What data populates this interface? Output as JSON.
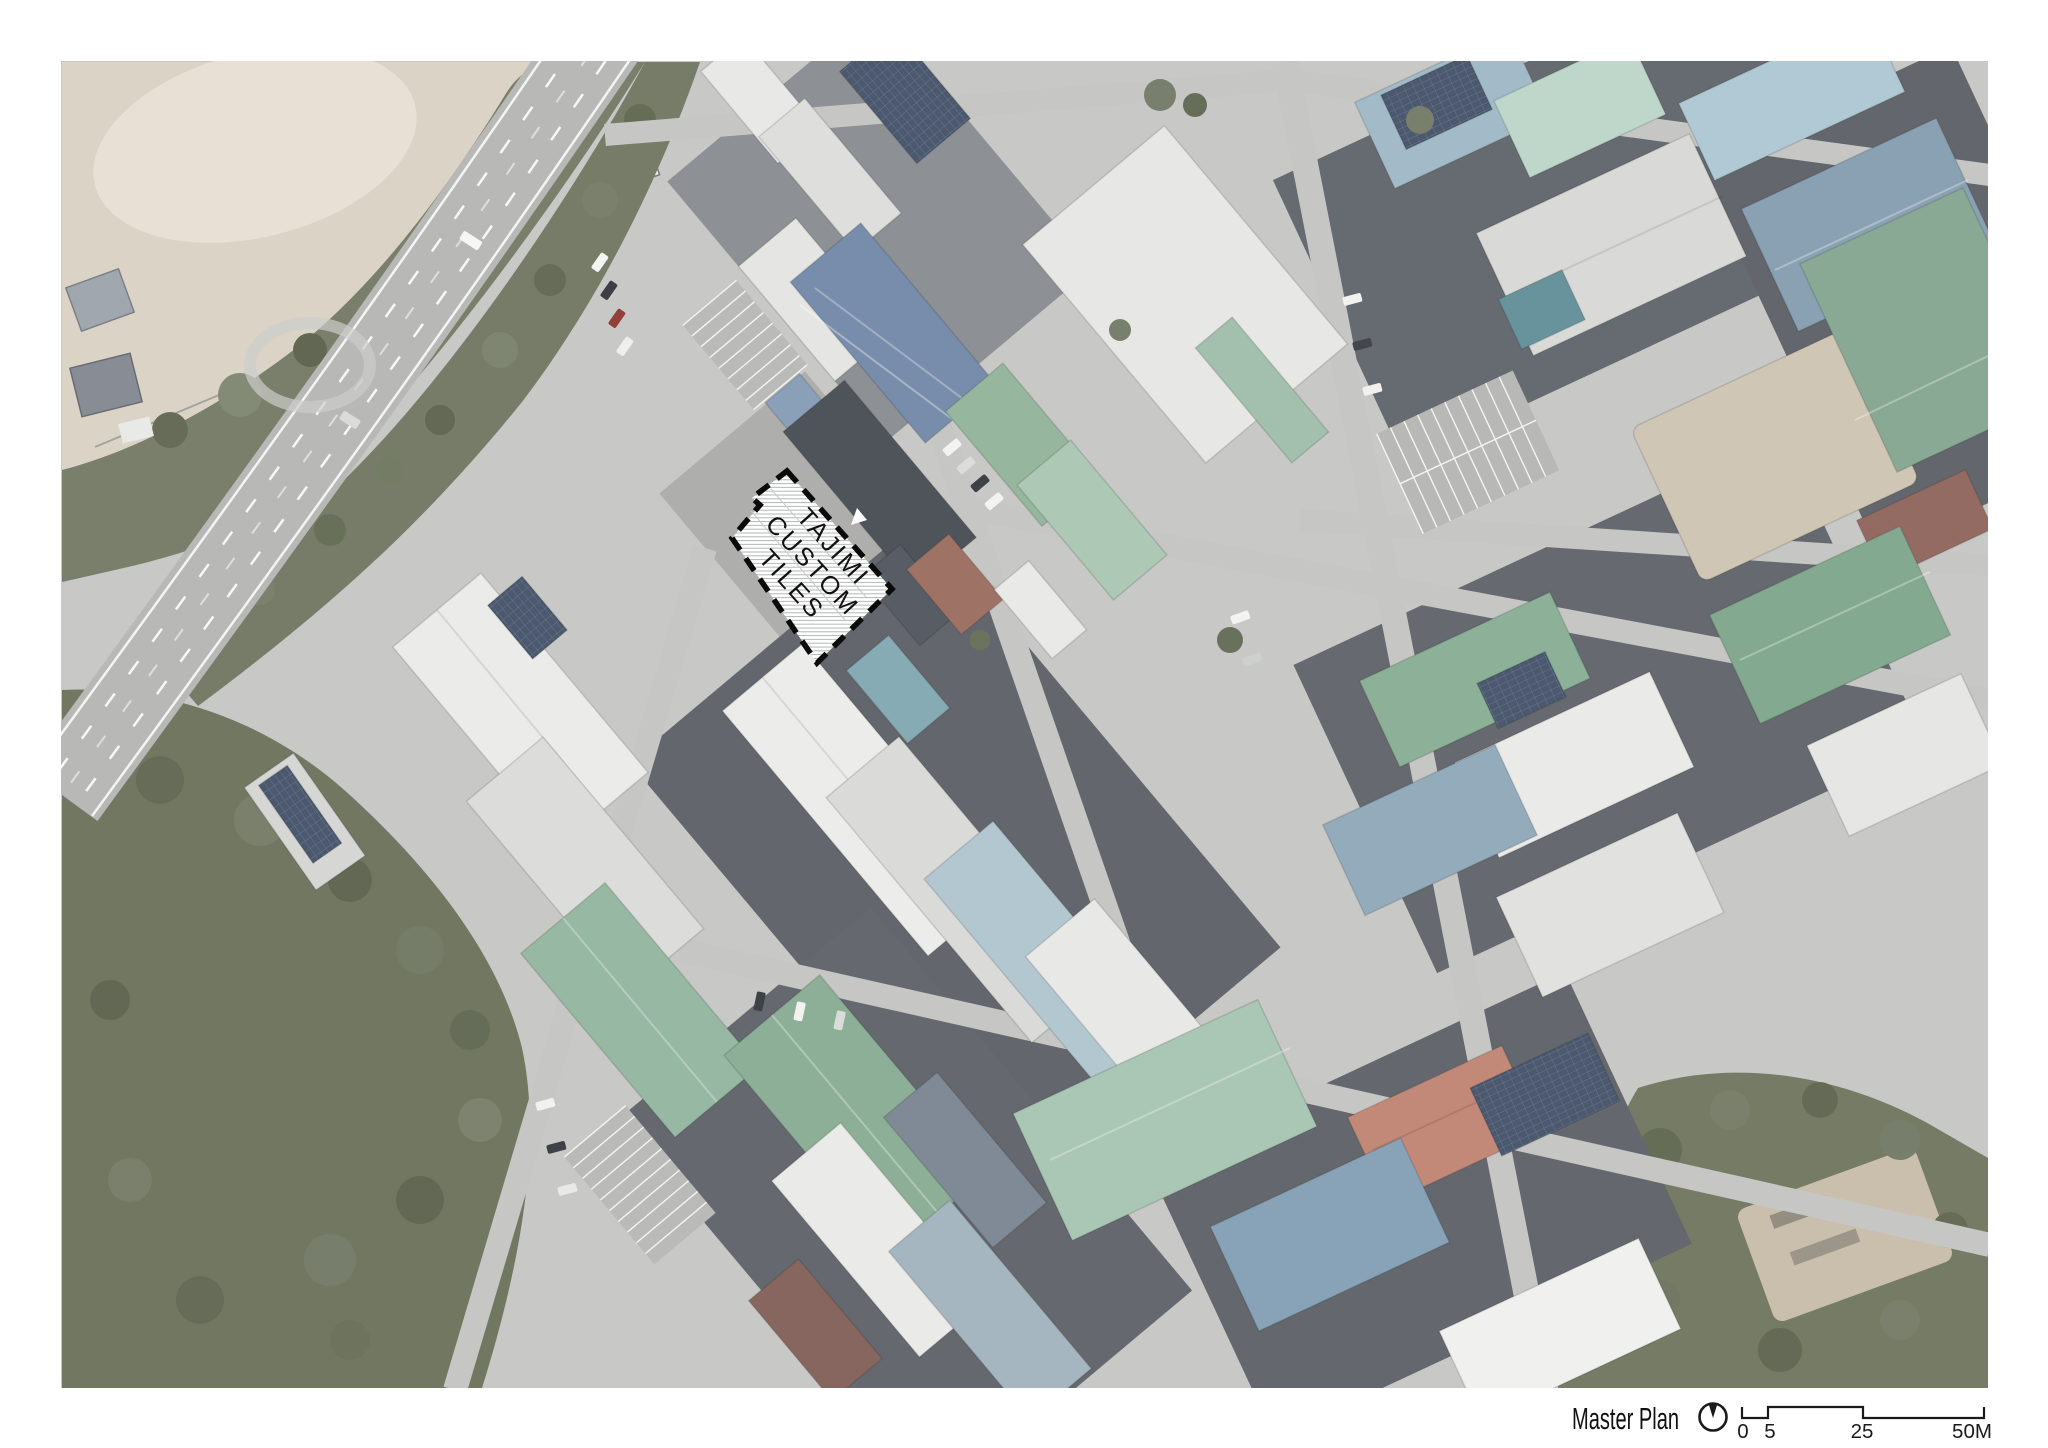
{
  "page": {
    "kind": "architectural master plan sheet on white background"
  },
  "photo": {
    "description": "Aerial photograph of an industrial warehouse district; a wide highway runs diagonally along a wooded slope at the upper left, a baseball field sits in the top-left corner, and a rotated grid of factory roofs (white, grey, green, blue, rust) fills the centre and right",
    "palette": {
      "ground": "#c4c4c2",
      "road": "#b2b2b0",
      "block_shadow": "#5c6167",
      "forest": "#6b715c",
      "field": "#d9d0c3",
      "roof_white": "#ebebe9",
      "roof_grey": "#d7d7d5",
      "roof_green": "#8fb29b",
      "roof_pale_green": "#bad4c6",
      "roof_blue": "#8aa4b6",
      "roof_pale_blue": "#aac5d2",
      "roof_navy_solar": "#3c4a61",
      "roof_red_brown": "#97675a",
      "roof_rust": "#8d6a55"
    }
  },
  "site": {
    "label_lines": [
      "TAJIMI",
      "CUSTOM",
      "TILES"
    ],
    "marker_style": "black dashed boundary, white fill with fine horizontal hatch",
    "pointer_icon": "white-triangle",
    "boundary_color": "#0a0a0a"
  },
  "legend": {
    "title": "Master Plan",
    "north_icon": "circle with needle pointing up (north)",
    "scale_labels": [
      "0",
      "5",
      "25",
      "50M"
    ],
    "text_color": "#111111"
  }
}
